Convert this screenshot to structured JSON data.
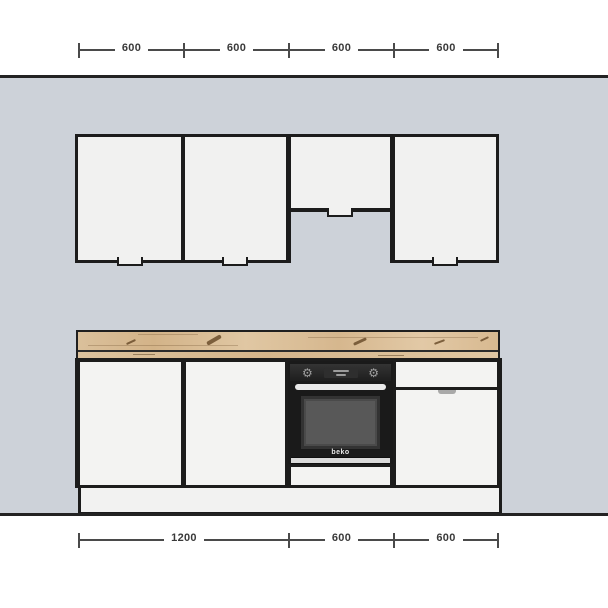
{
  "scene": {
    "title": "kitchen-elevation-plan"
  },
  "colors": {
    "wall": "#cdd2d9",
    "outline": "#1c1c1c",
    "cabinet_front": "#f2f2f1",
    "dim_line": "#4a4a4a",
    "dim_text": "#3a3a3a",
    "counter_wood": "#d8ba92",
    "counter_knot": "#6b4d2c",
    "oven_body": "#1a1a1a",
    "oven_window": "#585858",
    "oven_handle": "#e9e9e9"
  },
  "dims_top": {
    "segments": [
      {
        "label": "600"
      },
      {
        "label": "600"
      },
      {
        "label": "600"
      },
      {
        "label": "600"
      }
    ]
  },
  "dims_bottom": {
    "segments": [
      {
        "label": "1200"
      },
      {
        "label": "600"
      },
      {
        "label": "600"
      }
    ]
  },
  "oven": {
    "brand": "beko",
    "knob_icon": "⚙"
  }
}
